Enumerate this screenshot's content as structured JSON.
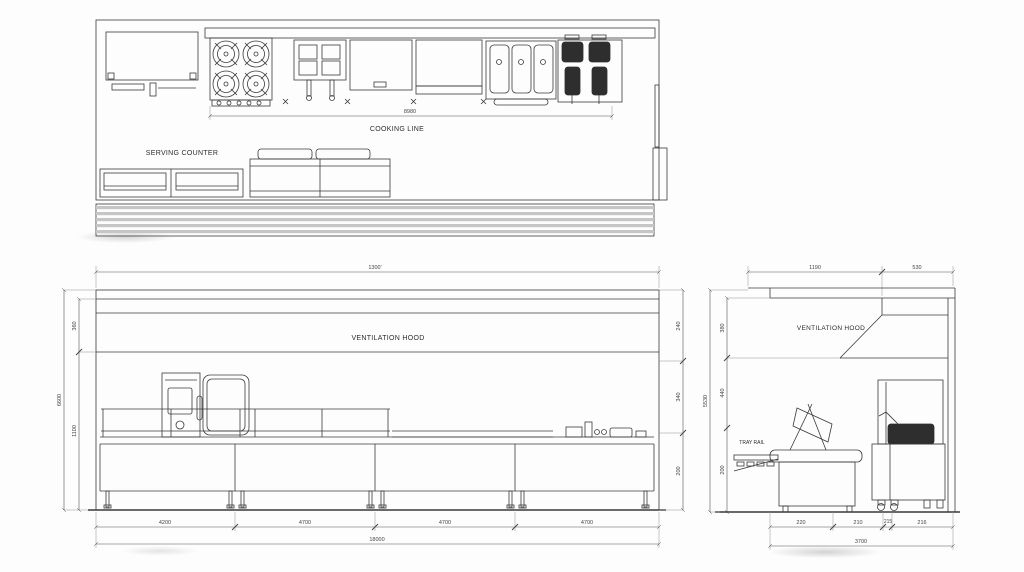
{
  "plan": {
    "cooking_line_dim": "8980",
    "cooking_line_label": "COOKING LINE",
    "serving_counter_label": "SERVING COUNTER"
  },
  "front": {
    "top_dim": "1300'",
    "hood_label": "VENTILATION HOOD",
    "dim_left_total": "6600",
    "dim_left_hood": "360",
    "dim_left_counter": "1100",
    "dim_right_top": "240",
    "dim_right_mid": "340",
    "dim_right_bottom": "200",
    "bottom_segments": [
      "4200",
      "4700",
      "4700",
      "4700"
    ],
    "bottom_total": "18000"
  },
  "side": {
    "hood_label": "VENTILATION HOOD",
    "tray_rail_label": "TRAY RAIL",
    "top_dim_left": "1190",
    "top_dim_right": "530",
    "dim_left_total": "5530",
    "dim_left_top": "380",
    "dim_left_mid": "440",
    "dim_left_bottom": "200",
    "bottom_segments": [
      "220",
      "210",
      "215",
      "216"
    ],
    "bottom_total": "3700"
  },
  "colors": {
    "line": "#3a3a3a",
    "dim_text": "#444444",
    "deck_stripe": "#c6c6c6",
    "background": "#fdfdfd"
  }
}
